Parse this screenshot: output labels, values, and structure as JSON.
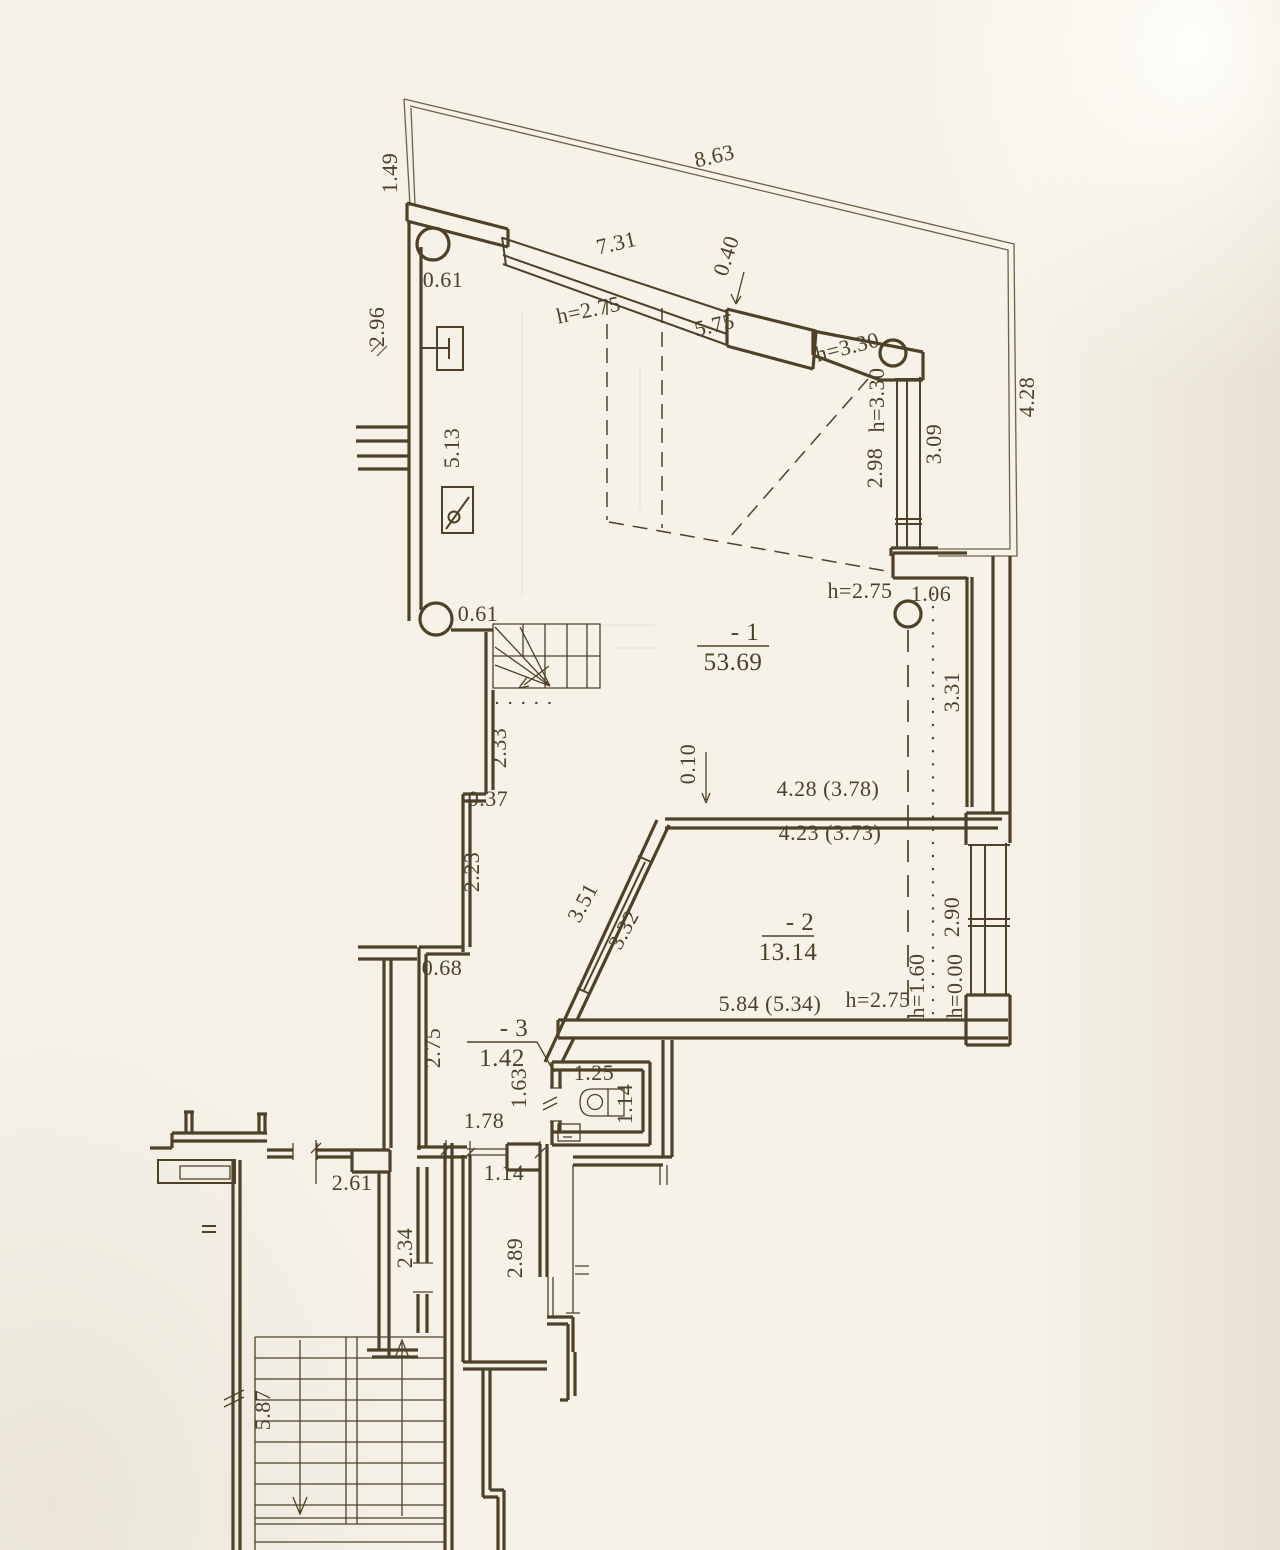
{
  "document": {
    "kind": "scanned architectural floor plan",
    "units": "meters"
  },
  "colors": {
    "paper": "#f6f2e8",
    "ink": "#4e4128",
    "boundary": "#6e6147"
  },
  "plan": {
    "rooms": [
      {
        "number": "- 1",
        "area": "53.69",
        "x": 733,
        "y": 646,
        "w": 36
      },
      {
        "number": "- 2",
        "area": "13.14",
        "x": 788,
        "y": 936,
        "w": 26
      },
      {
        "number": "- 3",
        "area": "1.42",
        "x": 502,
        "y": 1042,
        "w": 35
      }
    ],
    "dimensions": [
      {
        "t": "1.49",
        "x": 397,
        "y": 173,
        "r": -90
      },
      {
        "t": "8.63",
        "x": 716,
        "y": 163,
        "r": -13
      },
      {
        "t": "7.31",
        "x": 618,
        "y": 250,
        "r": -13
      },
      {
        "t": "0.40",
        "x": 733,
        "y": 258,
        "r": -72
      },
      {
        "t": "h=2.75",
        "x": 590,
        "y": 317,
        "r": -12
      },
      {
        "t": "5.75",
        "x": 716,
        "y": 332,
        "r": -13
      },
      {
        "t": "h=3.30",
        "x": 849,
        "y": 354,
        "r": -14
      },
      {
        "t": "h=3.30",
        "x": 884,
        "y": 400,
        "r": -90
      },
      {
        "t": "2.98",
        "x": 882,
        "y": 468,
        "r": -90
      },
      {
        "t": "3.09",
        "x": 941,
        "y": 444,
        "r": -90
      },
      {
        "t": "4.28",
        "x": 1034,
        "y": 397,
        "r": -90
      },
      {
        "t": "2.96",
        "x": 384,
        "y": 327,
        "r": -90
      },
      {
        "t": "5.13",
        "x": 459,
        "y": 448,
        "r": -90
      },
      {
        "t": "0.61",
        "x": 443,
        "y": 287,
        "r": 0
      },
      {
        "t": "h=2.75",
        "x": 860,
        "y": 598,
        "r": 0
      },
      {
        "t": "1.06",
        "x": 931,
        "y": 601,
        "r": 0
      },
      {
        "t": "3.31",
        "x": 959,
        "y": 692,
        "r": -90
      },
      {
        "t": "0.61",
        "x": 478,
        "y": 621,
        "r": 0
      },
      {
        "t": "2.33",
        "x": 506,
        "y": 748,
        "r": -90
      },
      {
        "t": "0.37",
        "x": 488,
        "y": 806,
        "r": 0
      },
      {
        "t": "2.23",
        "x": 479,
        "y": 872,
        "r": -90
      },
      {
        "t": "0.10",
        "x": 695,
        "y": 764,
        "r": -90
      },
      {
        "t": "4.28 (3.78)",
        "x": 828,
        "y": 796,
        "r": 0
      },
      {
        "t": "4.23 (3.73)",
        "x": 830,
        "y": 840,
        "r": 0
      },
      {
        "t": "3.51",
        "x": 589,
        "y": 906,
        "r": -62
      },
      {
        "t": "3.32",
        "x": 630,
        "y": 933,
        "r": -62
      },
      {
        "t": "2.90",
        "x": 959,
        "y": 917,
        "r": -90
      },
      {
        "t": "5.84 (5.34)",
        "x": 770,
        "y": 1011,
        "r": 0
      },
      {
        "t": "h=2.75",
        "x": 878,
        "y": 1007,
        "r": 0
      },
      {
        "t": "h=1.60",
        "x": 924,
        "y": 986,
        "r": -90
      },
      {
        "t": "h=0.00",
        "x": 962,
        "y": 986,
        "r": -90
      },
      {
        "t": "0.68",
        "x": 442,
        "y": 975,
        "r": 0
      },
      {
        "t": "2.75",
        "x": 440,
        "y": 1048,
        "r": -90
      },
      {
        "t": "1.63",
        "x": 526,
        "y": 1088,
        "r": -90
      },
      {
        "t": "1.25",
        "x": 594,
        "y": 1080,
        "r": 0
      },
      {
        "t": "1.14",
        "x": 632,
        "y": 1104,
        "r": -90
      },
      {
        "t": "1.78",
        "x": 484,
        "y": 1128,
        "r": 0
      },
      {
        "t": "1.14",
        "x": 504,
        "y": 1180,
        "r": 0
      },
      {
        "t": "2.89",
        "x": 522,
        "y": 1258,
        "r": -90
      },
      {
        "t": "2.61",
        "x": 352,
        "y": 1190,
        "r": 0
      },
      {
        "t": "2.34",
        "x": 412,
        "y": 1248,
        "r": -90
      },
      {
        "t": "5.87",
        "x": 270,
        "y": 1410,
        "r": -90
      }
    ]
  }
}
